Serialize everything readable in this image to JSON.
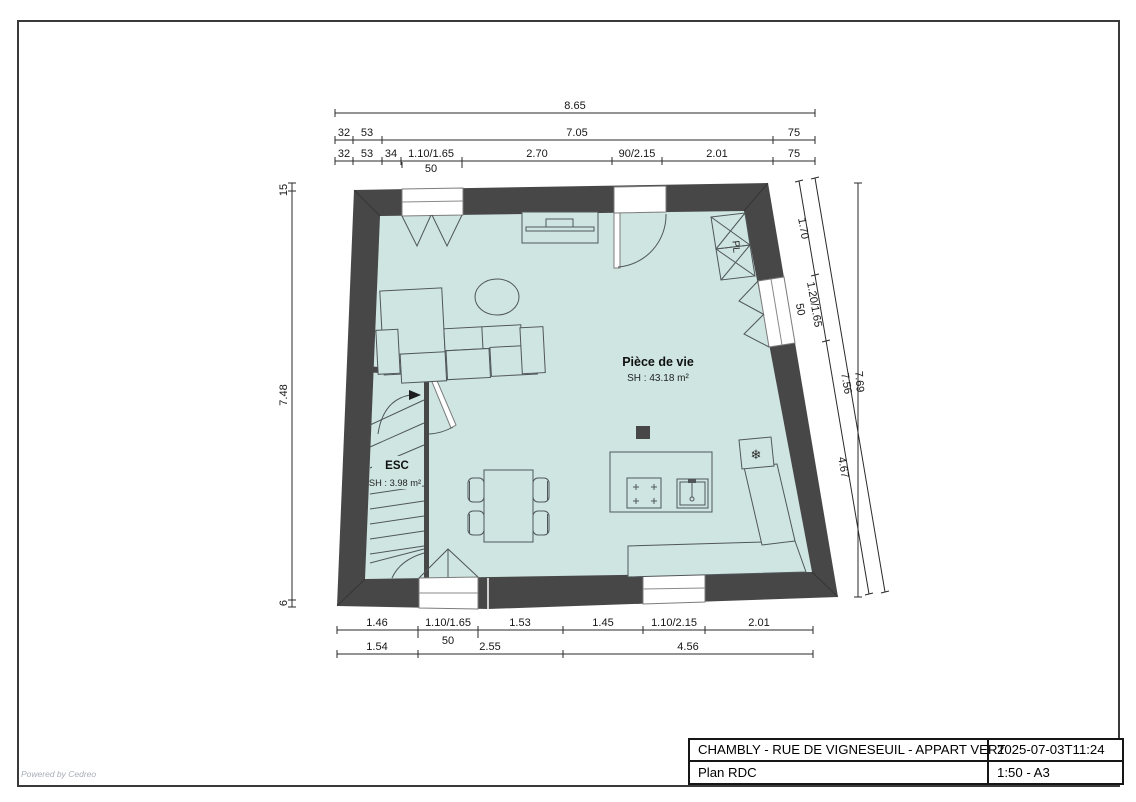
{
  "colors": {
    "wall": "#474747",
    "floor": "#cee5e1"
  },
  "page": {
    "watermark": "Powered by Cedreo"
  },
  "title_block": {
    "project": "CHAMBLY - RUE DE VIGNESEUIL - APPART VERT",
    "datetime": "2025-07-03T11:24",
    "plan_name": "Plan RDC",
    "scale_format": "1:50 - A3"
  },
  "rooms": {
    "living": {
      "name": "Pièce de vie",
      "area_label": "SH : 43.18 m²"
    },
    "stairs": {
      "name": "ESC",
      "area_label": "SH : 3.98 m²"
    },
    "closet": {
      "name": "PL"
    }
  },
  "symbols": {
    "fridge_snowflake": "❄"
  },
  "dimensions": {
    "top": {
      "total": "8.65",
      "row2": [
        "32",
        "53",
        "7.05",
        "75"
      ],
      "row3": [
        "32",
        "53",
        "34",
        "1.10/1.65",
        "2.70",
        "90/2.15",
        "2.01",
        "75"
      ],
      "window_sill": "50"
    },
    "bottom": {
      "row1": [
        "1.46",
        "1.10/1.65",
        "1.53",
        "1.45",
        "1.10/2.15",
        "2.01"
      ],
      "row2": [
        "1.54",
        "2.55",
        "4.56"
      ],
      "window_sill": "50"
    },
    "left": [
      "15",
      "7.48",
      "6"
    ],
    "right": {
      "segments": [
        "1.70",
        "1.20/1.65",
        "4.67"
      ],
      "window_sill": "50",
      "total_inner": "7.56",
      "total_outer": "7.69"
    }
  }
}
